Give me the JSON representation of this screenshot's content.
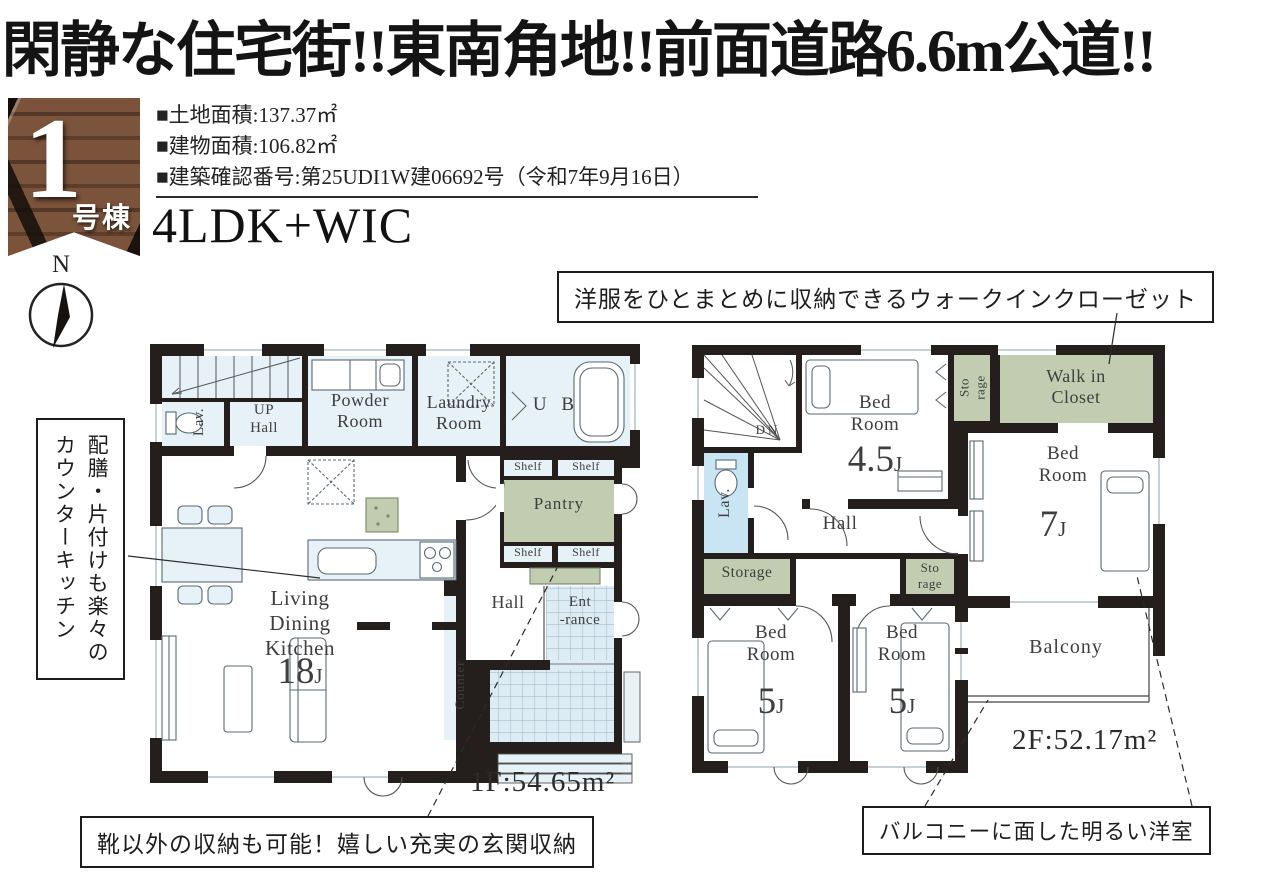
{
  "headline": "閑静な住宅街!!東南角地!!前面道路6.6m公道!!",
  "badge": {
    "number": "1",
    "suffix": "号棟"
  },
  "specs": {
    "land": "■土地面積:137.37㎡",
    "building": "■建物面積:106.82㎡",
    "permit": "■建築確認番号:第25UDI1W建06692号（令和7年9月16日）",
    "layout": "4LDK+WIC"
  },
  "compass": {
    "north": "N"
  },
  "callouts": {
    "wic": "洋服をひとまとめに収納できるウォークインクローゼット",
    "kitchen_line1": "配膳・片付けも楽々の",
    "kitchen_line2": "カウンターキッチン",
    "genkan": "靴以外の収納も可能！嬉しい充実の玄関収納",
    "balcony": "バルコニーに面した明るい洋室"
  },
  "floor1": {
    "area": "1F:54.65m²",
    "labels": {
      "lav": "Lav.",
      "up": "UP",
      "up_hall": "Hall",
      "powder": "Powder Room",
      "laundry": "Laundry Room",
      "ub": "U B",
      "shelf": "Shelf",
      "pantry": "Pantry",
      "ldk": "Living Dining Kitchen",
      "ldk_size": "18",
      "unit": "J",
      "hall": "Hall",
      "entrance_l1": "Ent",
      "entrance_l2": "-rance",
      "counter": "Counter"
    }
  },
  "floor2": {
    "area": "2F:52.17m²",
    "labels": {
      "dn": "DN",
      "bedroom": "Bed Room",
      "size45": "4.5",
      "size7": "7",
      "size5": "5",
      "unit": "J",
      "hall": "Hall",
      "lav": "Lav.",
      "storage": "Storage",
      "storage_small": "Sto rage",
      "wic": "Walk in Closet",
      "balcony": "Balcony"
    }
  },
  "colors": {
    "wall": "#241f1d",
    "room_blue": "#e7f1f8",
    "green": "#c1ccb0",
    "lav_blue": "#c9e5f4",
    "tile": "#dcebf4"
  }
}
